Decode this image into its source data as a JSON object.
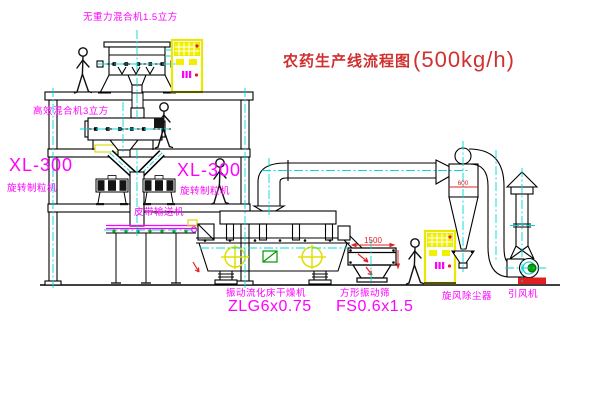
{
  "title": {
    "name": "农药生产线流程图",
    "capacity": "(500kg/h)"
  },
  "equipment": {
    "mixer_top": {
      "label": "无重力混合机1.5立方"
    },
    "mixer_2f": {
      "label": "高效混合机3立方"
    },
    "granulator_left": {
      "model": "XL-300",
      "label": "旋转制粒机"
    },
    "granulator_mid": {
      "model": "XL-300",
      "label": "旋转制粒机"
    },
    "belt_conveyor": {
      "label": "皮带输送机"
    },
    "dryer": {
      "label": "振动流化床干燥机",
      "model": "ZLG6x0.75"
    },
    "screen": {
      "label": "方形振动筛",
      "model": "FS0.6x1.5",
      "dim_width": "1500"
    },
    "cyclone": {
      "label": "旋风除尘器",
      "dim_diameter": "600"
    },
    "fan": {
      "label": "引风机"
    }
  },
  "colors": {
    "line": "#000000",
    "centerline": "#00D8D8",
    "label_magenta": "#FF00FF",
    "title_red": "#D03030",
    "dimension_red": "#E02020",
    "cabinet_yellow": "#F0F000",
    "motor_green": "#00A800"
  }
}
